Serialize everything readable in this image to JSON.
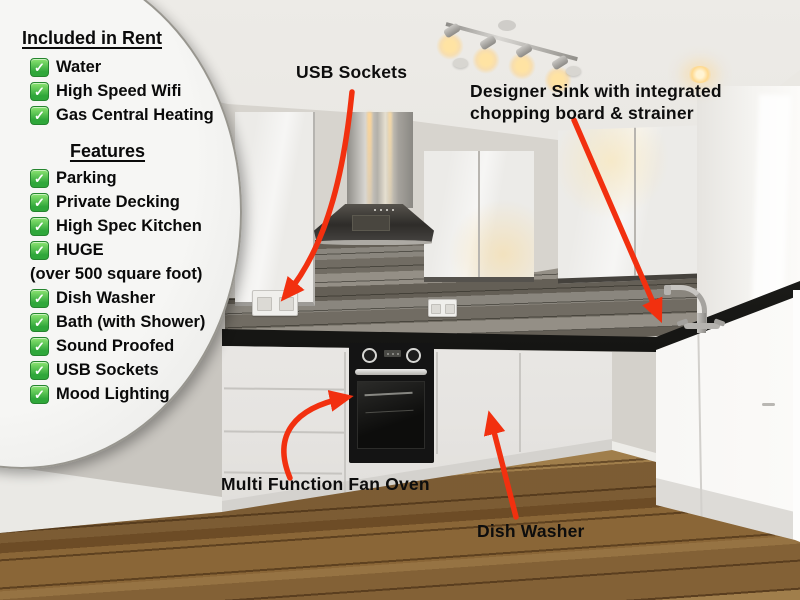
{
  "panel": {
    "included_title": "Included in Rent",
    "included_items": [
      {
        "label": "Water"
      },
      {
        "label": "High Speed Wifi"
      },
      {
        "label": "Gas Central Heating"
      }
    ],
    "features_title": "Features",
    "features_items": [
      {
        "label": "Parking"
      },
      {
        "label": "Private Decking"
      },
      {
        "label": "High Spec Kitchen"
      },
      {
        "label": "HUGE",
        "note": "(over 500 square foot)"
      },
      {
        "label": "Dish Washer"
      },
      {
        "label": "Bath (with Shower)"
      },
      {
        "label": "Sound Proofed"
      },
      {
        "label": "USB Sockets"
      },
      {
        "label": "Mood Lighting"
      }
    ],
    "check_glyph": "✓"
  },
  "annotations": {
    "usb_label": "USB Sockets",
    "sink_label_line1": "Designer Sink with integrated",
    "sink_label_line2": "chopping board & strainer",
    "oven_label": "Multi Function Fan Oven",
    "dishwasher_label": "Dish Washer"
  },
  "colors": {
    "arrow_red": "#f2300f",
    "check_green": "#2fa73a",
    "label_black": "#0d0d0d"
  }
}
